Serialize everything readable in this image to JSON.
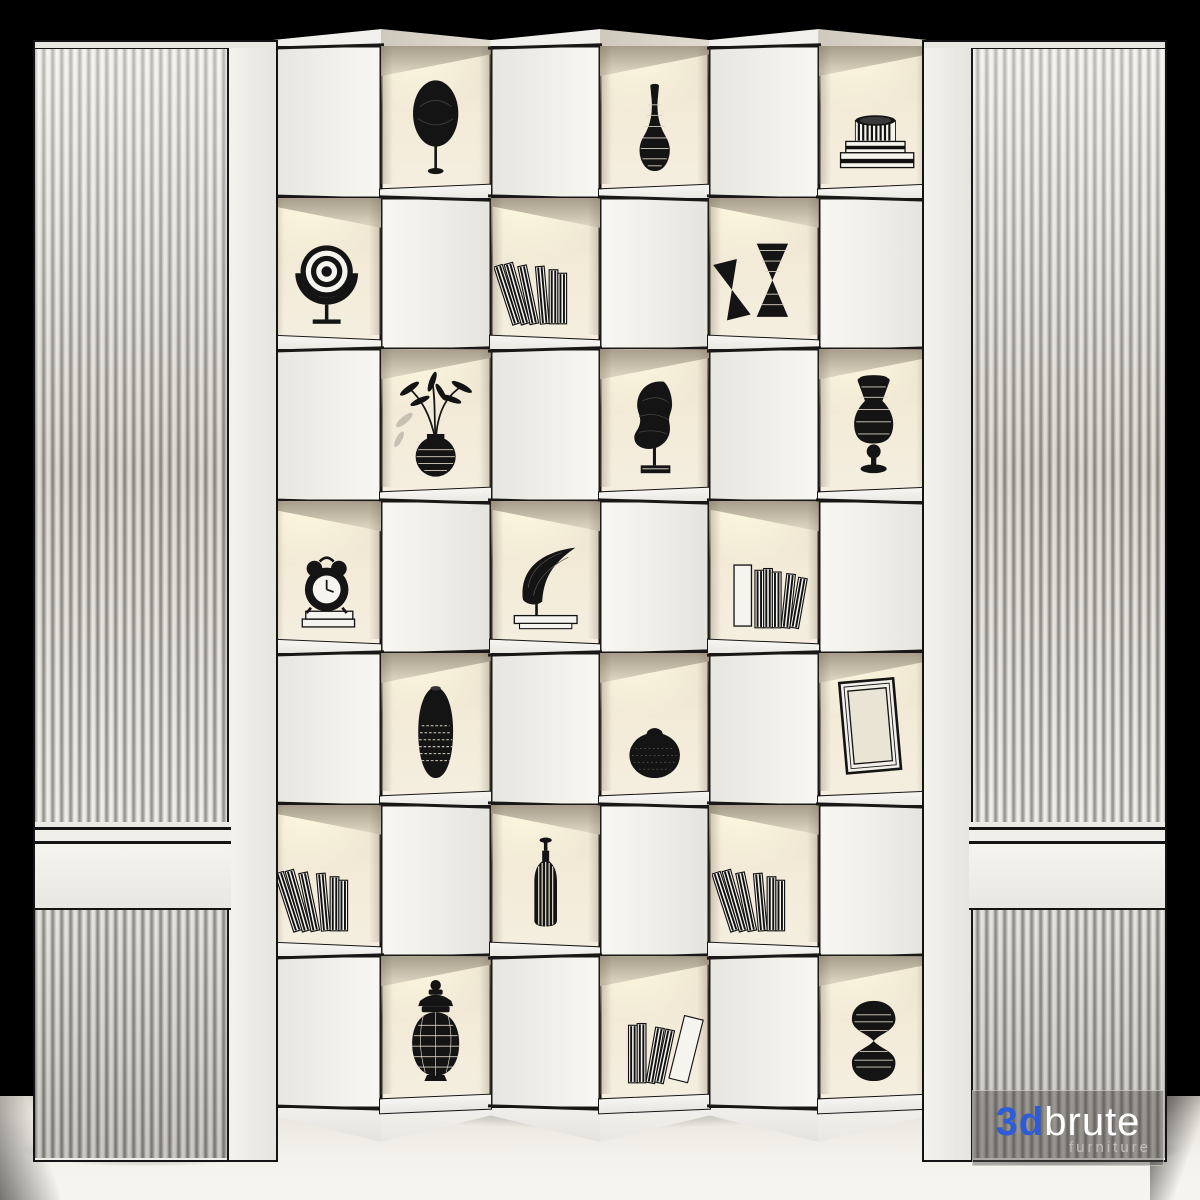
{
  "scene": {
    "background_color": "#000000",
    "floor_color": "#f2efe9",
    "panel_color": "#efeee9",
    "unit_face_color": "#f1f0ec",
    "cell_interior_color": "#f0e8d6",
    "cell_glow_color": "#fff8e3",
    "outline_color": "#161616",
    "object_color": "#141414",
    "book_white": "#f6f4ee",
    "hatch_light": "#d9d2c2"
  },
  "watermark": {
    "prefix": "3d",
    "name": "brute",
    "subtitle": "furniture",
    "prefix_color": "#2d5cd6",
    "name_color": "#ffffff",
    "subtitle_color": "#bfbdba"
  },
  "panels": {
    "left": {
      "type": "fluted-slat-panel",
      "band": true
    },
    "right": {
      "type": "fluted-slat-panel",
      "band": true
    }
  },
  "shelf": {
    "rows": 7,
    "columns": 6,
    "items": [
      {
        "row": 1,
        "col": 2,
        "object": "egg-sculpture",
        "label": "black egg sculpture on stand"
      },
      {
        "row": 1,
        "col": 4,
        "object": "wicker-bottle-vase",
        "label": "wireframe bottle vase"
      },
      {
        "row": 1,
        "col": 6,
        "object": "striped-box-stack",
        "label": "ribbed round box on striped slabs"
      },
      {
        "row": 2,
        "col": 1,
        "object": "rings-sculpture",
        "label": "concentric rings ornament"
      },
      {
        "row": 2,
        "col": 3,
        "object": "leaning-striped-books",
        "label": "leaning striped books"
      },
      {
        "row": 2,
        "col": 5,
        "object": "hourglass-vases",
        "label": "pair of hourglass shaped vases"
      },
      {
        "row": 3,
        "col": 2,
        "object": "plant-in-wicker-pot",
        "label": "bamboo plant in wicker pot"
      },
      {
        "row": 3,
        "col": 4,
        "object": "face-sculpture",
        "label": "wireframe face sculpture on stand"
      },
      {
        "row": 3,
        "col": 6,
        "object": "wicker-table-lamp",
        "label": "wireframe table lamp"
      },
      {
        "row": 4,
        "col": 1,
        "object": "alarm-clock-on-books",
        "label": "alarm clock on stacked books"
      },
      {
        "row": 4,
        "col": 3,
        "object": "horn-sculpture",
        "label": "horn sculpture on book"
      },
      {
        "row": 4,
        "col": 5,
        "object": "striped-books-row",
        "label": "white box with striped books"
      },
      {
        "row": 5,
        "col": 2,
        "object": "tall-patterned-vase",
        "label": "tall black patterned vase"
      },
      {
        "row": 5,
        "col": 4,
        "object": "round-black-pot",
        "label": "round black pot"
      },
      {
        "row": 5,
        "col": 6,
        "object": "empty-picture-frame",
        "label": "leaning empty picture frame"
      },
      {
        "row": 6,
        "col": 1,
        "object": "leaning-striped-books",
        "label": "leaning striped books"
      },
      {
        "row": 6,
        "col": 3,
        "object": "striped-bottle",
        "label": "tall striped bottle with stopper"
      },
      {
        "row": 6,
        "col": 5,
        "object": "leaning-striped-books",
        "label": "leaning striped books"
      },
      {
        "row": 7,
        "col": 2,
        "object": "wicker-ginger-jar",
        "label": "wireframe lidded jar"
      },
      {
        "row": 7,
        "col": 4,
        "object": "leaning-white-books",
        "label": "leaning white books"
      },
      {
        "row": 7,
        "col": 6,
        "object": "wicker-hourglass",
        "label": "wireframe hourglass"
      }
    ]
  }
}
